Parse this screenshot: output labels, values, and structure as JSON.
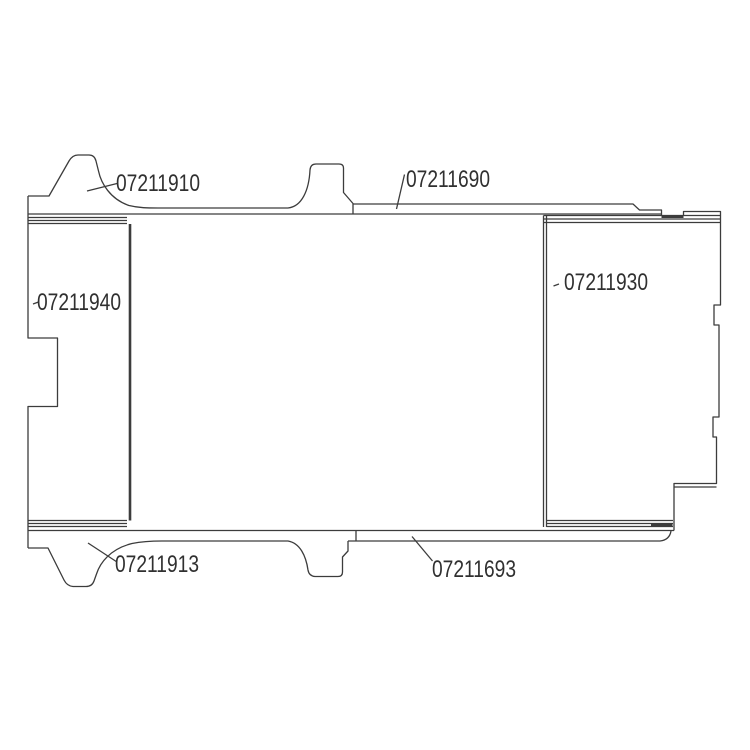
{
  "drawing": {
    "background_color": "#ffffff",
    "line_color": "#3c3c3c",
    "label_color": "#303030",
    "parts": [
      {
        "number": "07211910"
      },
      {
        "number": "07211690"
      },
      {
        "number": "07211940"
      },
      {
        "number": "07211930"
      },
      {
        "number": "07211913"
      },
      {
        "number": "07211693"
      }
    ]
  }
}
